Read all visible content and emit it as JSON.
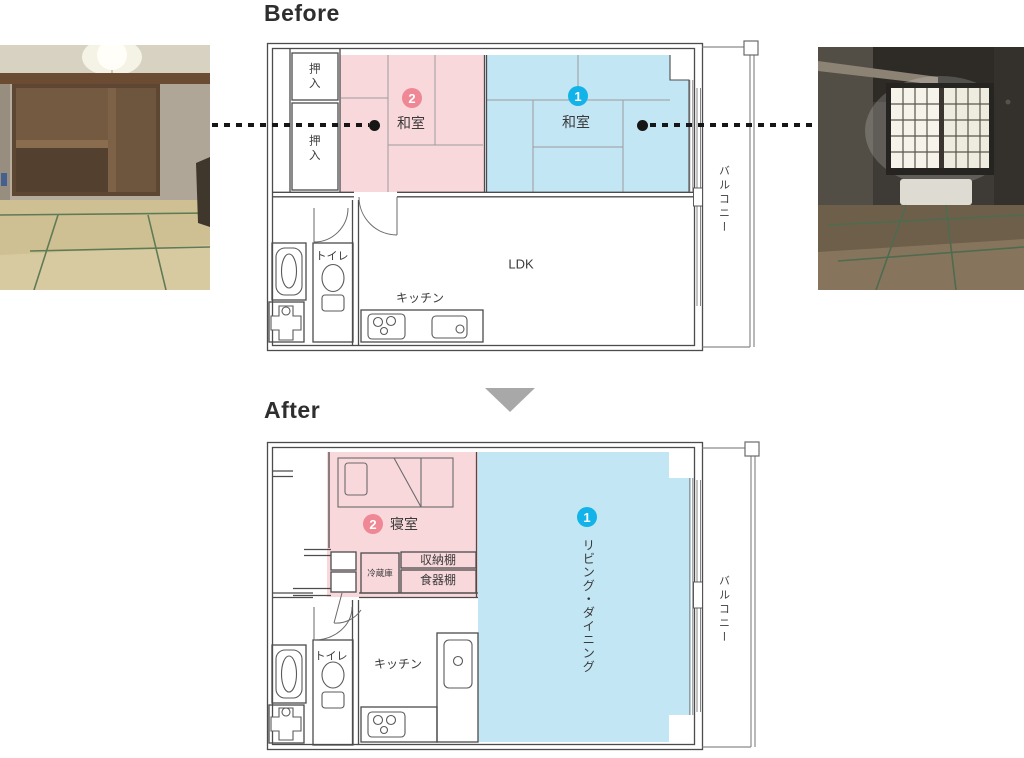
{
  "colors": {
    "room_pink": "#f9d8dc",
    "room_blue": "#c3e6f5",
    "badge_pink": "#ef8795",
    "badge_blue": "#12b3e8",
    "wall": "#4c4c4c",
    "arrow_gray": "#a8a8a8"
  },
  "icons": {
    "arrow_down": "▼"
  },
  "before": {
    "heading": "Before",
    "closet_top": "押入",
    "closet_bottom": "押入",
    "room2": {
      "number": "2",
      "name": "和室"
    },
    "room1": {
      "number": "1",
      "name": "和室"
    },
    "toilet": "トイレ",
    "kitchen": "キッチン",
    "ldk": "LDK",
    "balcony": "バルコニー"
  },
  "after": {
    "heading": "After",
    "bedroom": {
      "number": "2",
      "name": "寝室"
    },
    "living": {
      "number": "1",
      "name": "リビング・ダイニング"
    },
    "storage_shelf": "収納棚",
    "cupboard": "食器棚",
    "refrigerator": "冷蔵庫",
    "toilet": "トイレ",
    "kitchen": "キッチン",
    "balcony": "バルコニー"
  }
}
